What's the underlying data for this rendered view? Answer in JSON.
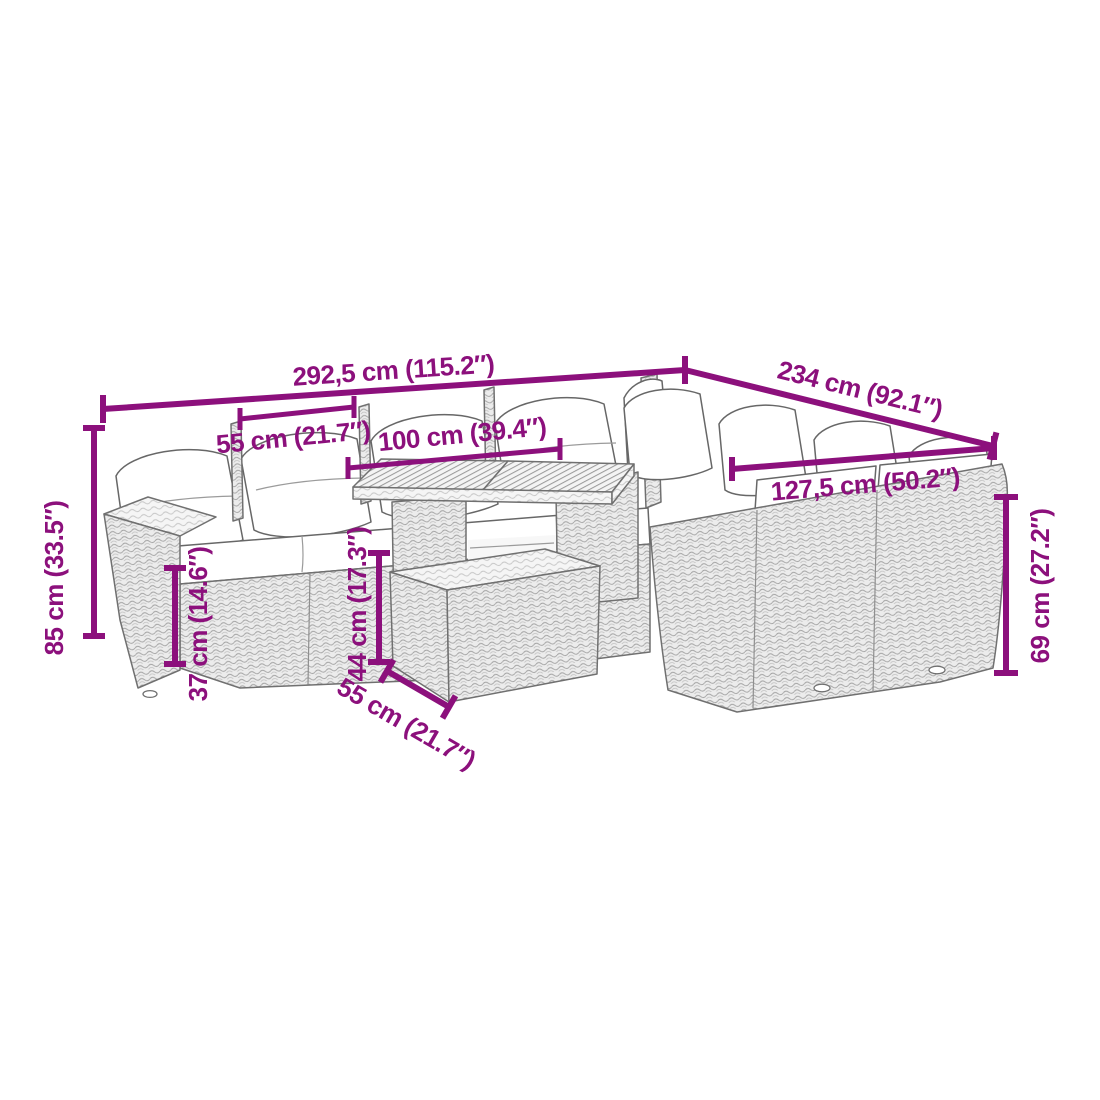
{
  "diagram": {
    "kind": "product-dimension-diagram",
    "dimensions": {
      "overall_width": "292,5 cm (115.2″)",
      "overall_depth": "234 cm (92.1″)",
      "seat_width": "55 cm (21.7″)",
      "table_top_length": "100 cm (39.4″)",
      "right_section_width": "127,5 cm (50.2″)",
      "overall_height": "85 cm (33.5″)",
      "seat_height": "37 cm (14.6″)",
      "table_height": "44 cm (17.3″)",
      "backrest_height": "69 cm (27.2″)",
      "table_top_depth": "55 cm (21.7″)"
    },
    "colors": {
      "dimension_annotation": "#8C107C",
      "line_art_outline": "#707070",
      "cushion_fill": "#ffffff"
    }
  }
}
